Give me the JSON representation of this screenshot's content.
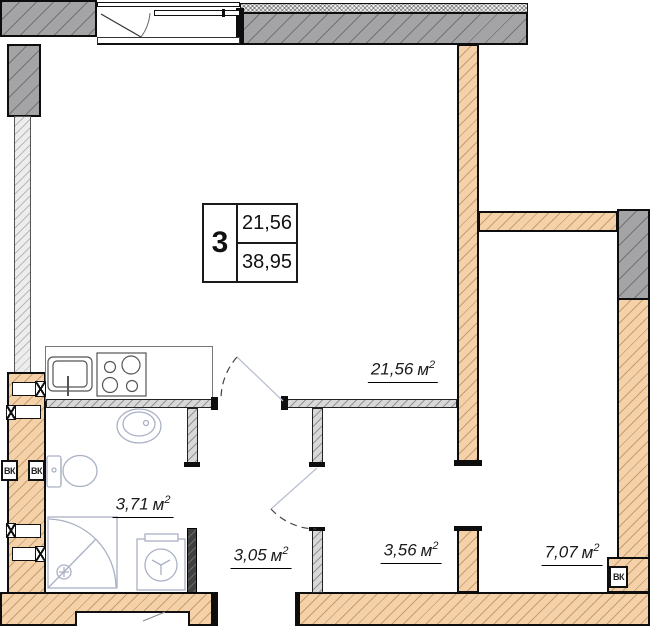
{
  "plan": {
    "info_box": {
      "flat_number": "3",
      "living_area": "21,56",
      "total_area": "38,95"
    },
    "area_unit": "м",
    "area_sup": "2",
    "vk_label": "ВК",
    "rooms": {
      "living": {
        "area": "21,56"
      },
      "bathroom": {
        "area": "3,71"
      },
      "hallway": {
        "area": "3,05"
      },
      "corridor": {
        "area": "3,56"
      },
      "bedroom": {
        "area": "7,07"
      }
    },
    "colors": {
      "concrete_wall": "#a4a4a6",
      "masonry_wall": "#f4d1a9",
      "partition": "#d8d8d8",
      "fixture_line": "#a9b1c4"
    }
  }
}
